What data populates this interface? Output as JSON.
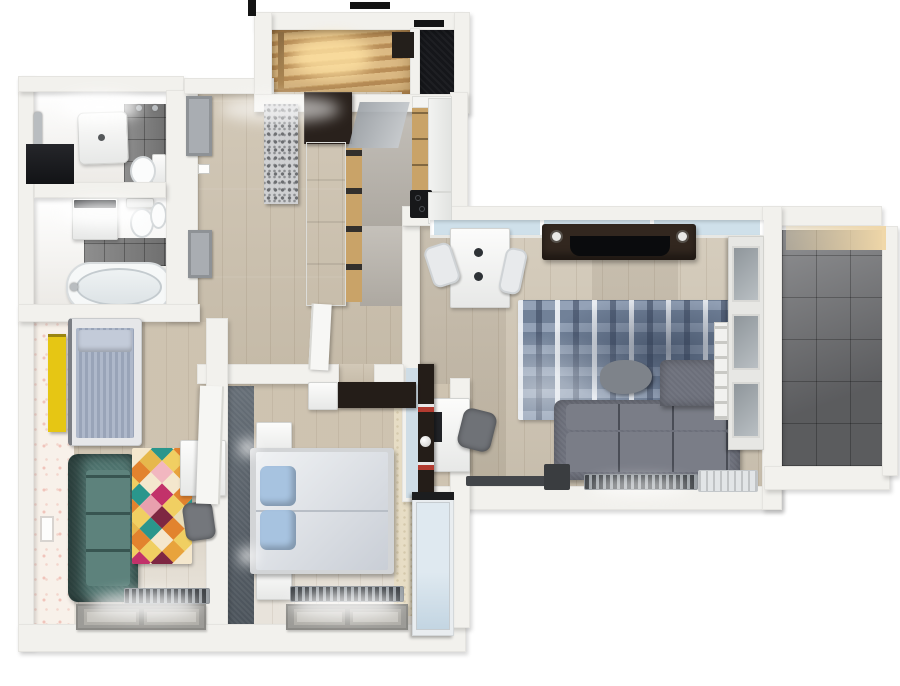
{
  "scene": {
    "type": "3d-floor-plan-top-view",
    "description": "rendered top-down 3d floor plan of an apartment, no on-screen text",
    "background": "#ffffff"
  },
  "palette": {
    "wall": "#f2f1ed",
    "wall_shade": "#d9d7d2",
    "wood": "#cdc2af",
    "kitchen_floor": "#b8b3ab",
    "tile": "#7f7f7f",
    "balcony_tile": "#6f7073",
    "slate": "#59626b",
    "glass": "#cfe0ea",
    "stair_wood": "#dcba84",
    "stair_glow": "#ffe2a2",
    "closet": "#15161a",
    "rug_blue": "#8293ab",
    "sofa": "#6c6f7a",
    "sofa_seat": "#7a7d87",
    "pouf": "#7e838a",
    "tv_brown": "#32271f",
    "tv_black": "#0a0b0d",
    "desk": "#edeff0",
    "teal": "#4e736e",
    "teal_light": "#5d827c",
    "yellow": "#e6c614",
    "wallpaper": "#f8f1ea",
    "duvet_a": "#f0f2f4",
    "duvet_b": "#c9ced6",
    "pillow": "#a7c3e0",
    "kids_mat": "#aeb8ca",
    "kids_mat_stripe": "#99a4b8",
    "wardrobe_a": "#dfe9f0",
    "wardrobe_b": "#c3d5e2",
    "beige": "#e7ddc5",
    "radiator": "#3e4246",
    "chrome": "#b9bdc0",
    "shelf_brown": "#241d18",
    "dark_wardrobe": "#29211c",
    "island_wood": "#c9a368",
    "warm_light": "#f0d7a8"
  },
  "rooms": [
    {
      "id": "shower-room",
      "floor": "white"
    },
    {
      "id": "bathroom",
      "floor": "white"
    },
    {
      "id": "entry-stairwell",
      "floor": "stairs"
    },
    {
      "id": "closet",
      "floor": "dark"
    },
    {
      "id": "hallway",
      "floor": "wood"
    },
    {
      "id": "kitchen",
      "floor": "gray"
    },
    {
      "id": "living-room",
      "floor": "wood"
    },
    {
      "id": "balcony",
      "floor": "gray-tile"
    },
    {
      "id": "kids-room",
      "floor": "wood"
    },
    {
      "id": "bedroom",
      "floor": "wood"
    }
  ],
  "furniture": {
    "shower_room": [
      "shower-tray",
      "toilet",
      "towel-bar",
      "dark-niche",
      "tile-wall"
    ],
    "bathroom": [
      "washing-machine",
      "toilet",
      "bidet",
      "bathtub",
      "tile-wall"
    ],
    "hallway": [
      "wall-frames",
      "terrazzo-wardrobe",
      "dark-wardrobe",
      "white-cabinet-run",
      "open-door"
    ],
    "kitchen": [
      "wood-cabinets",
      "counters",
      "cooktop",
      "glass-panel"
    ],
    "living_room": [
      "window",
      "desk",
      "two-chairs",
      "tv-unit",
      "speakers",
      "tv",
      "blue-rug",
      "pouf",
      "corner-sofa",
      "workstation-desk",
      "office-chair",
      "bookshelf",
      "display-cabinet",
      "ladder-shelf",
      "radiator",
      "ac-unit",
      "side-table"
    ],
    "balcony": [],
    "kids_room": [
      "yellow-shelf",
      "single-bed",
      "teal-sofa",
      "diamond-rug",
      "desk",
      "chair",
      "open-door",
      "radiator",
      "window",
      "wall-frame"
    ],
    "bedroom": [
      "double-bed",
      "pillows",
      "nightstands",
      "dresser",
      "dark-shelf",
      "accent-wall",
      "wardrobe",
      "radiator",
      "window",
      "wall-lights"
    ]
  },
  "kids_room": {
    "rug_colors": [
      [
        "#7e2742",
        "#f4e7cd",
        "#2a968c",
        "#b5893a",
        "#e2832e",
        "#f0cf62"
      ],
      [
        "#f4e7cd",
        "#e2832e",
        "#f0cf62",
        "#2a968c",
        "#f0b7c2",
        "#b5893a"
      ],
      [
        "#2a968c",
        "#f0cf62",
        "#e8a33c",
        "#f4e7cd",
        "#7e2742",
        "#e2832e"
      ],
      [
        "#e6b84c",
        "#f2b7c0",
        "#f4e7cd",
        "#e2832e",
        "#2a968c",
        "#f4e7cd"
      ],
      [
        "#e2832e",
        "#f4e7cd",
        "#c2326a",
        "#f0cf62",
        "#e8ddb8",
        "#2a968c"
      ],
      [
        "#f0cf62",
        "#2a968c",
        "#e8a0ae",
        "#7e2742",
        "#e2832e",
        "#f0cf62"
      ],
      [
        "#f4e7cd",
        "#e2832e",
        "#f0cf62",
        "#2a968c",
        "#f4e7cd",
        "#e8a33c"
      ],
      [
        "#2a968c",
        "#f2b7c0",
        "#e6b84c",
        "#e2832e",
        "#f0cf62",
        "#7e2742"
      ],
      [
        "#e2832e",
        "#f4e7cd",
        "#2a968c",
        "#f0cf62",
        "#c2326a",
        "#f4e7cd"
      ],
      [
        "#f0cf62",
        "#e8a33c",
        "#e2832e",
        "#f4e7cd",
        "#2a968c",
        "#e2832e"
      ]
    ]
  }
}
